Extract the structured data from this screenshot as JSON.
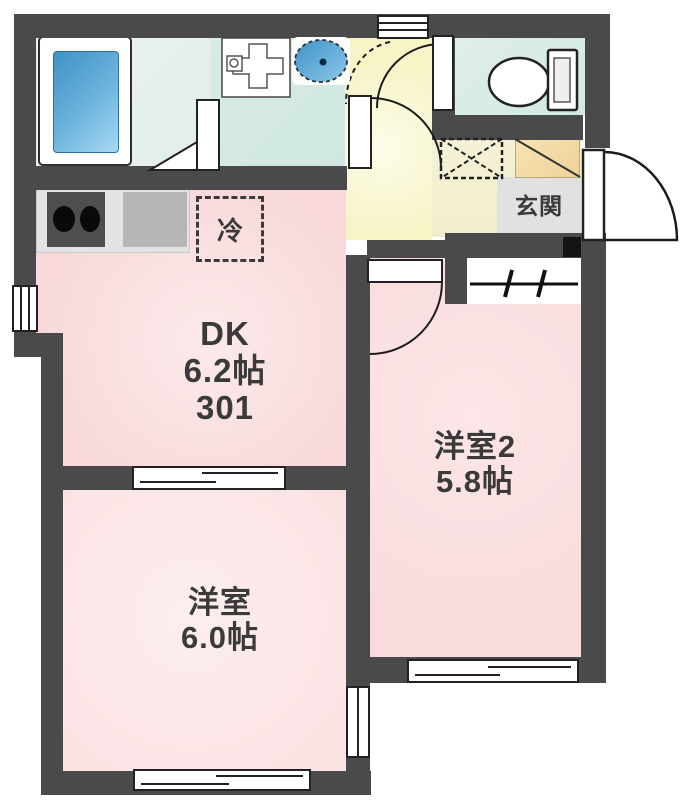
{
  "labels": {
    "dk_name": "DK",
    "dk_size": "6.2帖",
    "unit_number": "301",
    "bedroom1_name": "洋室",
    "bedroom1_size": "6.0帖",
    "bedroom2_name": "洋室2",
    "bedroom2_size": "5.8帖",
    "entrance": "玄関",
    "refrigerator": "冷"
  },
  "fixtures": {
    "bathtub": "rounded rectangle with blue water fill",
    "washbasin_unit": "square unit with plus-shaped counter and faucet",
    "basin_bowl": "blue dashed oval bowl with drain dot",
    "toilet": "oval bowl with rectangular tank",
    "stove": "dark block with two black burner circles",
    "refrigerator_space": "dashed square labeled 冷",
    "washing_machine_space": "dashed square with X",
    "shoe_cabinet": "tan box with diagonal line",
    "hanger_pole": "horizontal bar with two cross ticks",
    "doors": "quarter-circle swing arcs",
    "windows": "white double-line wall symbols"
  },
  "colors": {
    "wall": "#4a4a4b",
    "text": "#3a3a3a",
    "dk": "#f8d8da",
    "b1": "#fbe3e4",
    "b2": "#f9dbdd",
    "hall": "#f7f4c8",
    "wet": "#d8ebe5",
    "genkan": "#e1e1e1",
    "shoe": "#f0d298",
    "tub_blue": "#4f9fd0",
    "basin_blue": "#55a5d8"
  }
}
